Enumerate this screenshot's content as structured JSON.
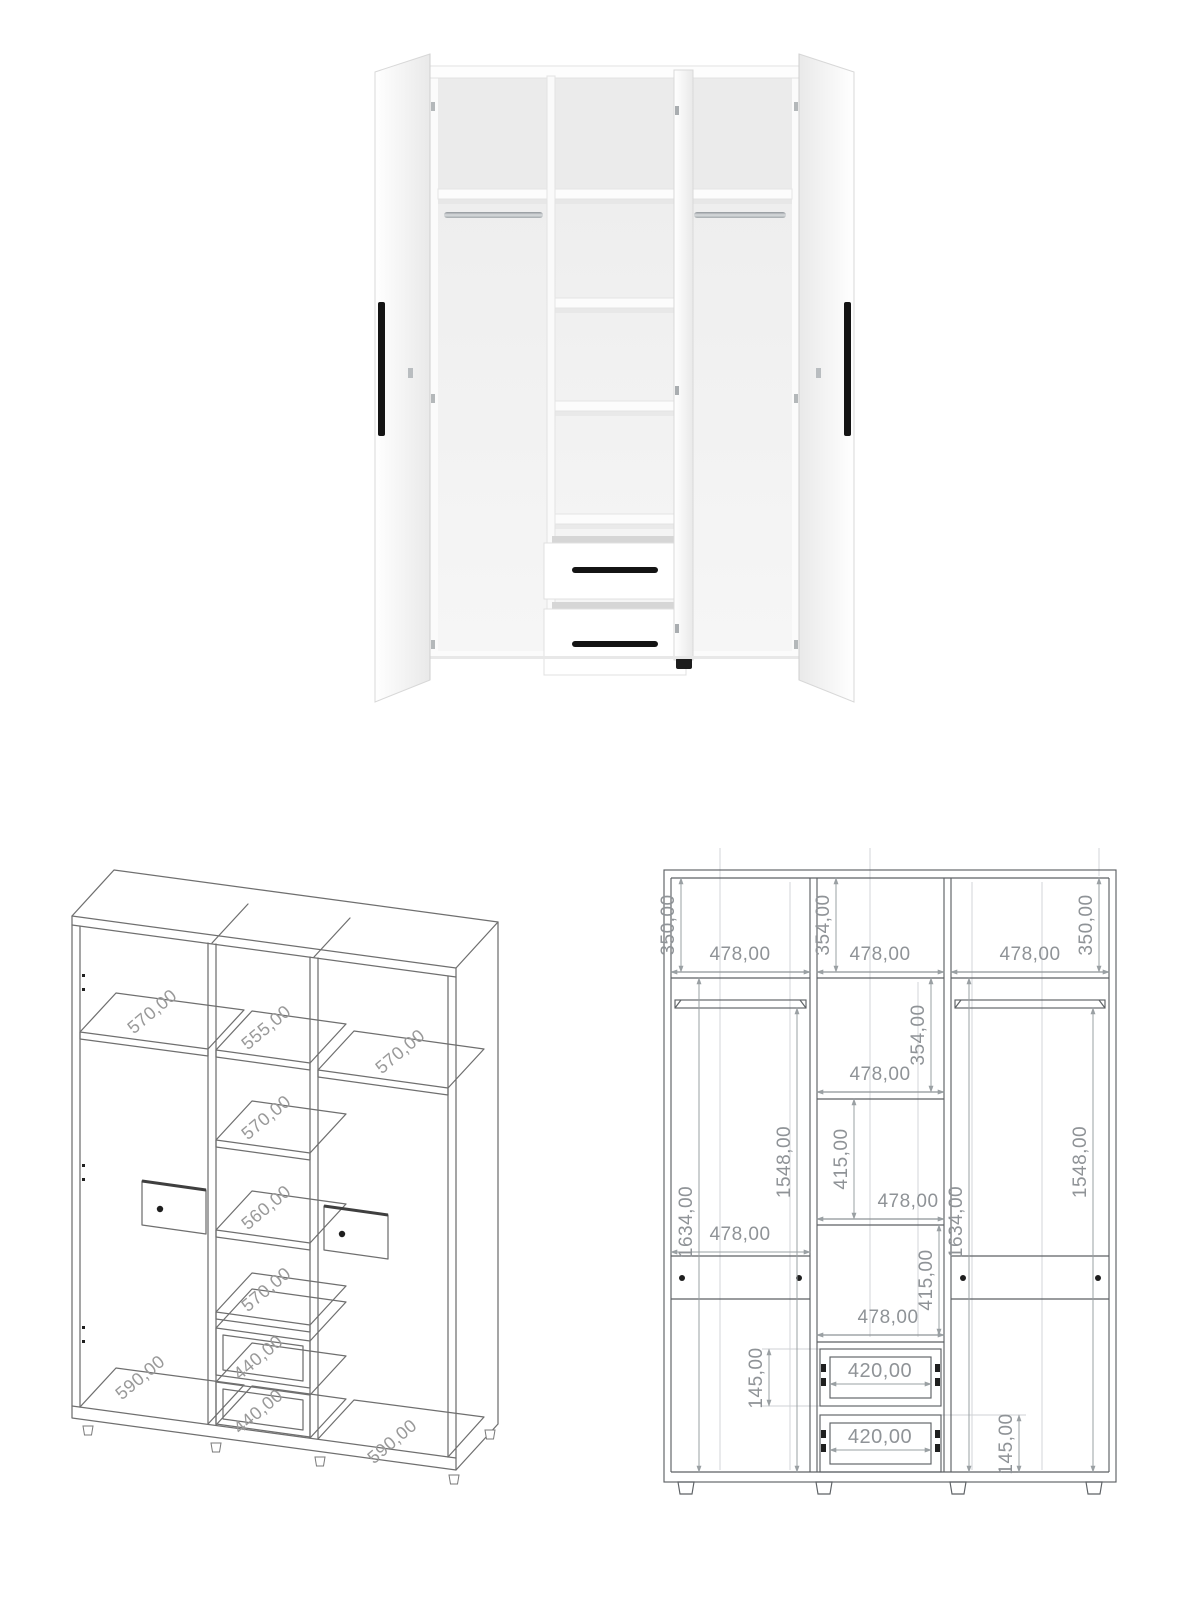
{
  "page": {
    "background": "#ffffff"
  },
  "render_view": {
    "description": "open-three-door-white-wardrobe-render",
    "colors": {
      "body": "#fbfbfb",
      "edge": "#dcdcdc",
      "interior": "#efefef",
      "rail": "#b3b8bb",
      "handle": "#141414",
      "feet": "#1d1d1d"
    }
  },
  "iso_view": {
    "line_color": "#6f6f6f",
    "label_color": "#999999",
    "labels": [
      "570,00",
      "555,00",
      "570,00",
      "570,00",
      "560,00",
      "570,00",
      "440,00",
      "440,00",
      "590,00",
      "590,00"
    ]
  },
  "elevation_view": {
    "line_color": "#5d6165",
    "dim_color": "#9aa0a3",
    "label_color": "#8f9397",
    "labels": {
      "top_left_height": "350,00",
      "top_left_width": "478,00",
      "top_center_height": "354,00",
      "top_center_width": "478,00",
      "top_right_width": "478,00",
      "top_right_height": "350,00",
      "center_row2_height": "354,00",
      "center_row2_width": "478,00",
      "left_column_height_a": "1634,00",
      "left_column_height_b": "1548,00",
      "center_row3_height": "415,00",
      "center_row3_width": "478,00",
      "right_column_height_a": "1634,00",
      "right_column_height_b": "1548,00",
      "center_row4_height": "415,00",
      "center_row4_width": "478,00",
      "left_lower_width": "478,00",
      "drawer1_width": "420,00",
      "drawer1_height": "145,00",
      "drawer2_width": "420,00",
      "drawer2_height": "145,00"
    }
  }
}
